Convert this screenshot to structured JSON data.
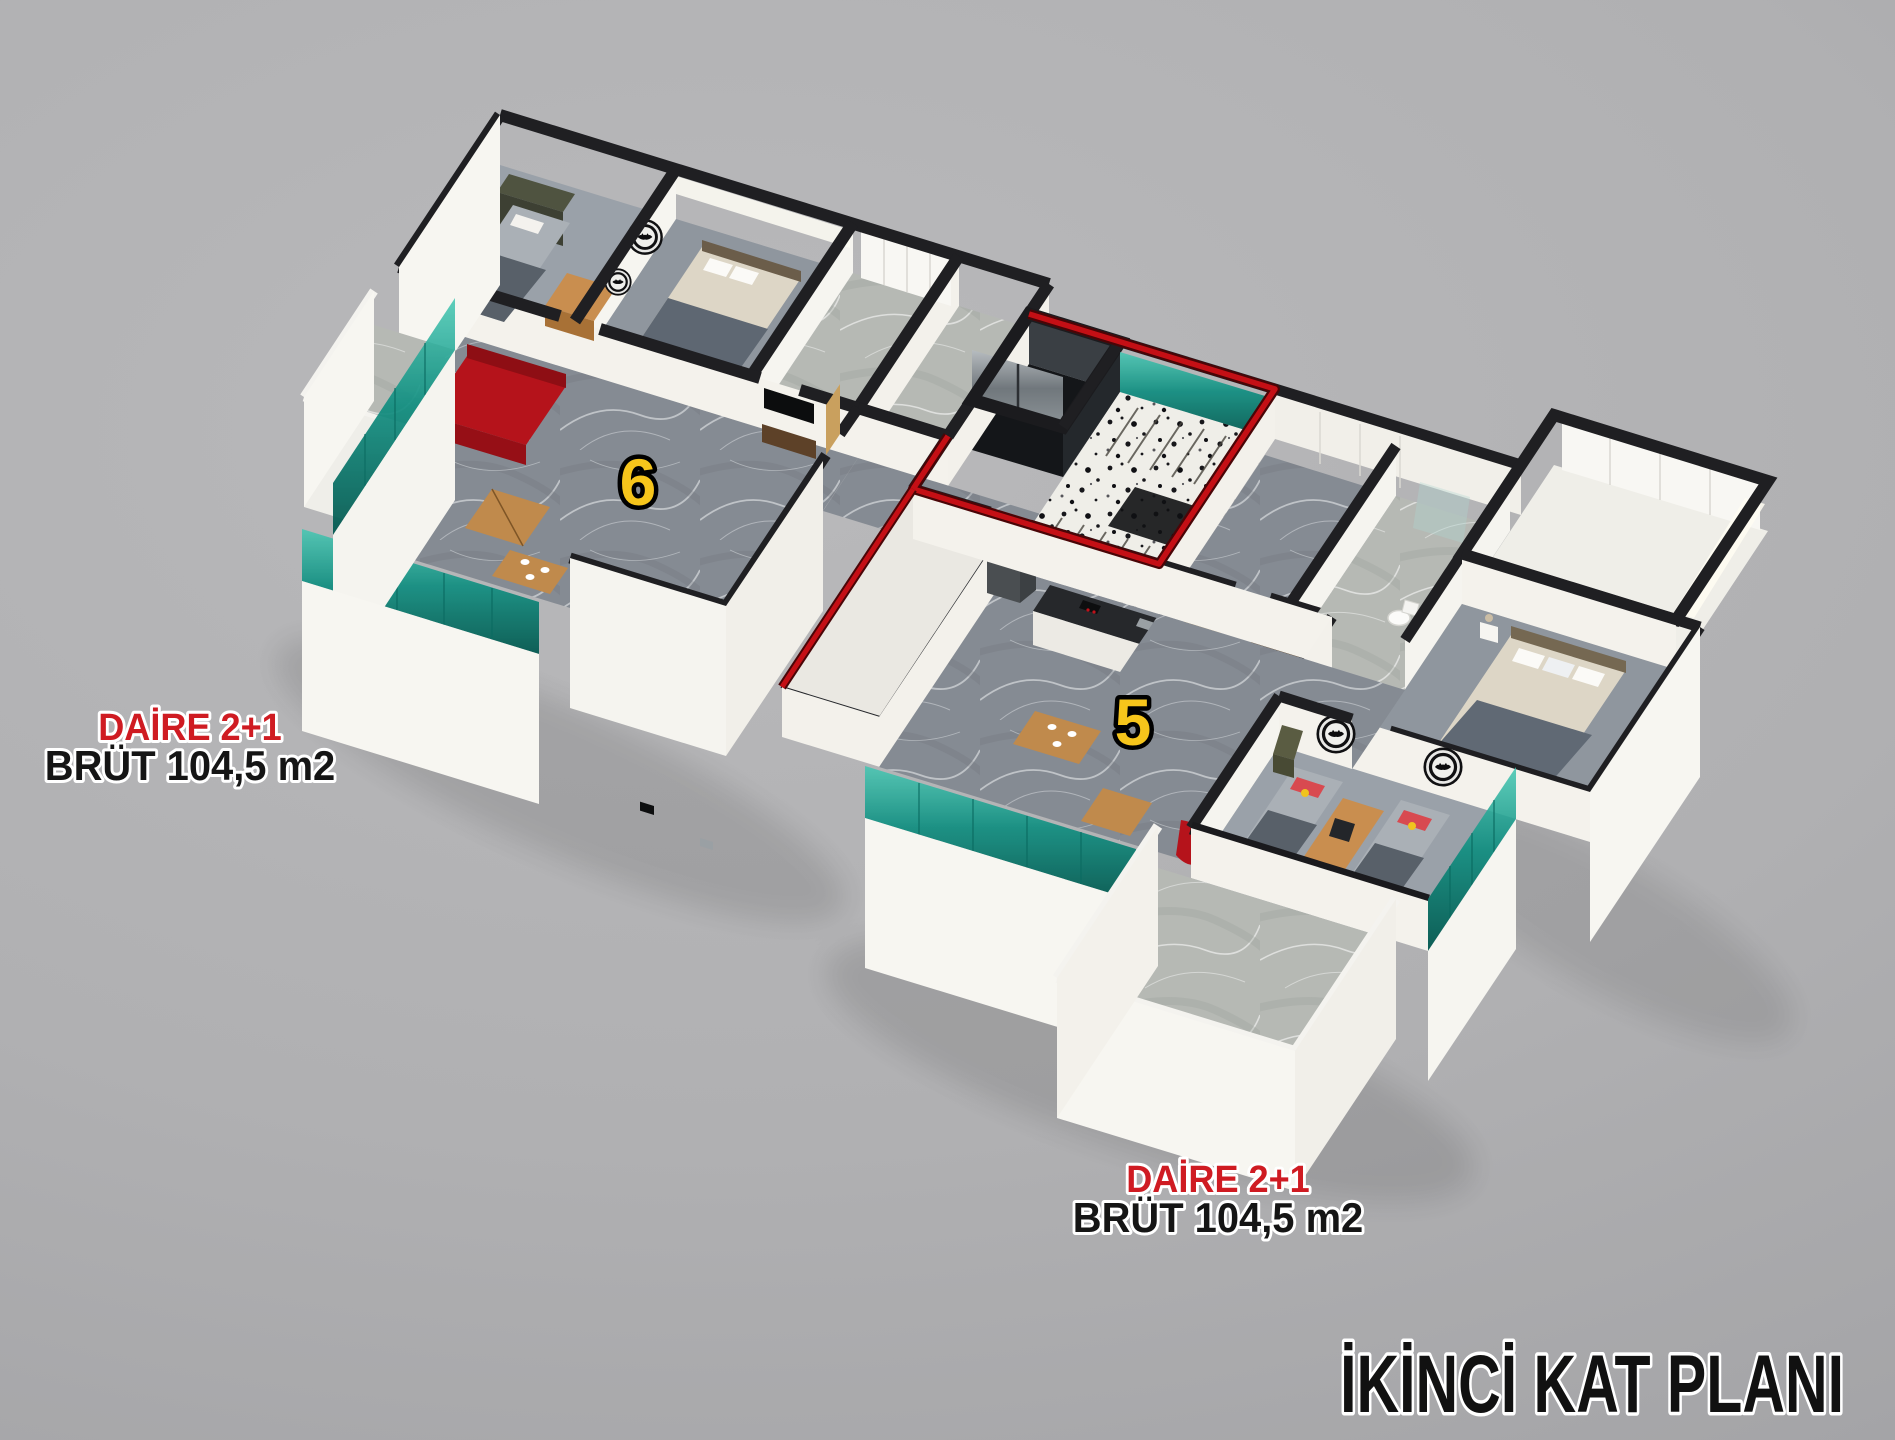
{
  "title": {
    "text": "İKİNCİ KAT PLANI",
    "color": "#111111"
  },
  "apartments": [
    {
      "badge": "6",
      "type_label": "DAİRE 2+1",
      "area_label": "BRÜT 104,5 m2"
    },
    {
      "badge": "5",
      "type_label": "DAİRE 2+1",
      "area_label": "BRÜT 104,5 m2"
    }
  ],
  "colors": {
    "background": "#b0b0b2",
    "label_red": "#cf1b22",
    "label_black": "#151515",
    "badge_yellow": "#f6c51b",
    "route_red": "#c40f15",
    "glass_teal": "#0f8d81",
    "wall_cap": "#1f1f22",
    "wall_white": "#f4f2ec"
  }
}
